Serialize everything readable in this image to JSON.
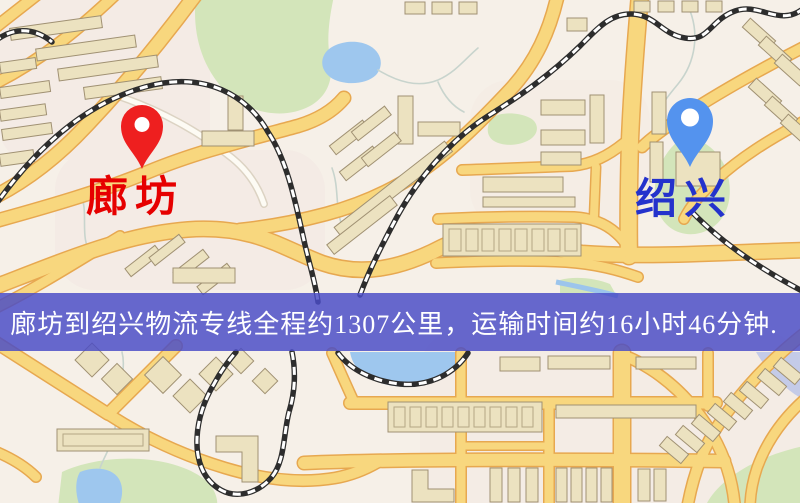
{
  "map": {
    "origin": {
      "label": "廊坊",
      "marker": "red-pin"
    },
    "destination": {
      "label": "绍兴",
      "marker": "blue-pin"
    }
  },
  "banner": {
    "text": "廊坊到绍兴物流专线全程约1307公里，运输时间约16小时46分钟.",
    "from": "廊坊",
    "to": "绍兴",
    "distance_km": "1307",
    "duration": "16小时46分钟"
  },
  "colors": {
    "map_bg": "#f6f0e8",
    "district_tint": "#f3e7e2",
    "green_area": "#d3e5ba",
    "water": "#9ec7ee",
    "road_fill": "#f8d77e",
    "road_casing": "#e7a850",
    "minor_road_fill": "#fdfbf4",
    "minor_road_casing": "#dcd3c3",
    "building_fill": "#ece2c0",
    "building_stroke": "#a09173",
    "railway": "#2d2d2d",
    "pin_red": "#ee1f1f",
    "pin_blue": "#5493ee",
    "origin_label": "#e60000",
    "destination_label": "#2432cc",
    "banner_bg": "rgba(74,76,198,0.84)",
    "banner_text": "#ffffff"
  }
}
